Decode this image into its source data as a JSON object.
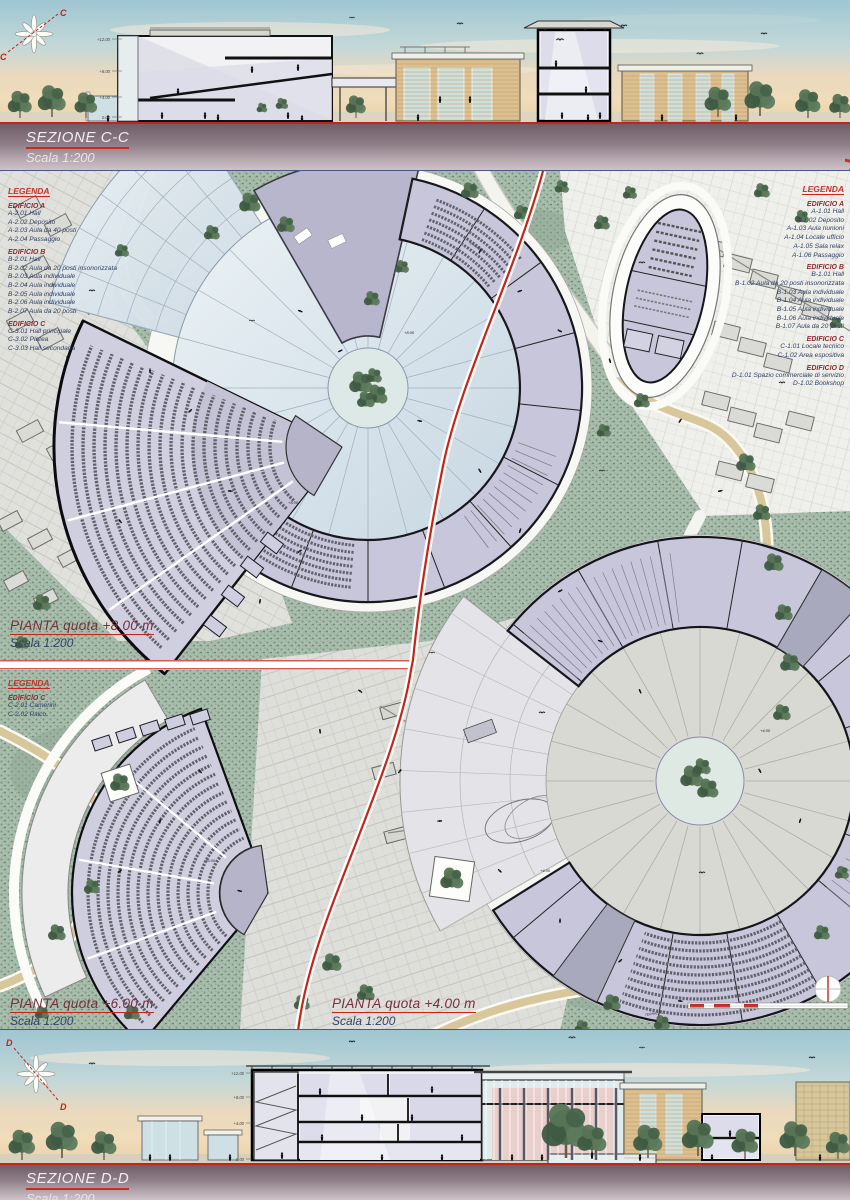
{
  "board": {
    "brand": "chiave di Sol"
  },
  "markers": {
    "section_c": "C",
    "section_d": "D"
  },
  "sections": {
    "top": {
      "title": "SEZIONE C-C",
      "scale": "Scala 1:200",
      "levels": [
        "+12.00",
        "+8.00",
        "+4.00",
        "0.00"
      ]
    },
    "bottom": {
      "title": "SEZIONE D-D",
      "scale": "Scala 1:200",
      "levels": [
        "+12.00",
        "+8.00",
        "+4.00",
        "0.00"
      ]
    }
  },
  "plans": {
    "p800": {
      "title": "PIANTA quota +8.00 m",
      "scale": "Scala 1:200",
      "level_mark": "+8.00"
    },
    "p600": {
      "title": "PIANTA quota +6.00 m",
      "scale": "Scala 1:200",
      "level_mark": "+6.00"
    },
    "p400": {
      "title": "PIANTA quota +4.00 m",
      "scale": "Scala 1:200",
      "level_mark": "+4.00"
    },
    "terrazzo": "TERRAZZO"
  },
  "legends": {
    "upper_left": {
      "title": "LEGENDA",
      "sections": [
        {
          "name": "EDIFICIO A",
          "items": [
            "A-2.01  Hall",
            "A-2.02  Deposito",
            "A-2.03  Aula da 40 posti",
            "A-2.04  Passaggio"
          ]
        },
        {
          "name": "EDIFICIO B",
          "items": [
            "B-2.01  Hall",
            "B-2.02  Aula da 20 posti insonorizzata",
            "B-2.03  Aula individuale",
            "B-2.04  Aula individuale",
            "B-2.05  Aula individuale",
            "B-2.06  Aula individuale",
            "B-2.07  Aula da 20 posti"
          ]
        },
        {
          "name": "EDIFICIO C",
          "items": [
            "C-3.01  Hall principale",
            "C-3.02  Platea",
            "C-3.03  Hall secondaria"
          ]
        }
      ]
    },
    "upper_right": {
      "title": "LEGENDA",
      "sections": [
        {
          "name": "EDIFICIO A",
          "items": [
            "A-1.01  Hall",
            "A-1.02  Deposito",
            "A-1.03  Aula riunioni",
            "A-1.04  Locale ufficio",
            "A-1.05  Sala relax",
            "A-1.06  Passaggio"
          ]
        },
        {
          "name": "EDIFICIO B",
          "items": [
            "B-1.01  Hall",
            "B-1.02  Aula da 20 posti insonorizzata",
            "B-1.03  Aula individuale",
            "B-1.04  Aula individuale",
            "B-1.05  Aula individuale",
            "B-1.06  Aula individuale",
            "B-1.07  Aula da 20 posti"
          ]
        },
        {
          "name": "EDIFICIO C",
          "items": [
            "C-1.01  Locale tecnico",
            "C-1.02  Area espositiva"
          ]
        },
        {
          "name": "EDIFICIO D",
          "items": [
            "D-1.01  Spazio commerciale di servizio",
            "D-1.02  Bookshop"
          ]
        }
      ]
    },
    "lower_left": {
      "title": "LEGENDA",
      "sections": [
        {
          "name": "EDIFICIO C",
          "items": [
            "C-2.01  Camerini",
            "C-2.02  Palco"
          ]
        }
      ]
    }
  },
  "colors": {
    "accent_red": "#c4241e",
    "legend_blue": "#2f3f63",
    "heading_maroon": "#8c2b33",
    "room_lavender": "#c7c6da",
    "grass_green": "#a9bdac",
    "path_tan": "#d9c79c",
    "sky_top": "#9fc6d2",
    "sky_horizon": "#ecd2a8",
    "strip_mauve": "#6f5e67"
  }
}
